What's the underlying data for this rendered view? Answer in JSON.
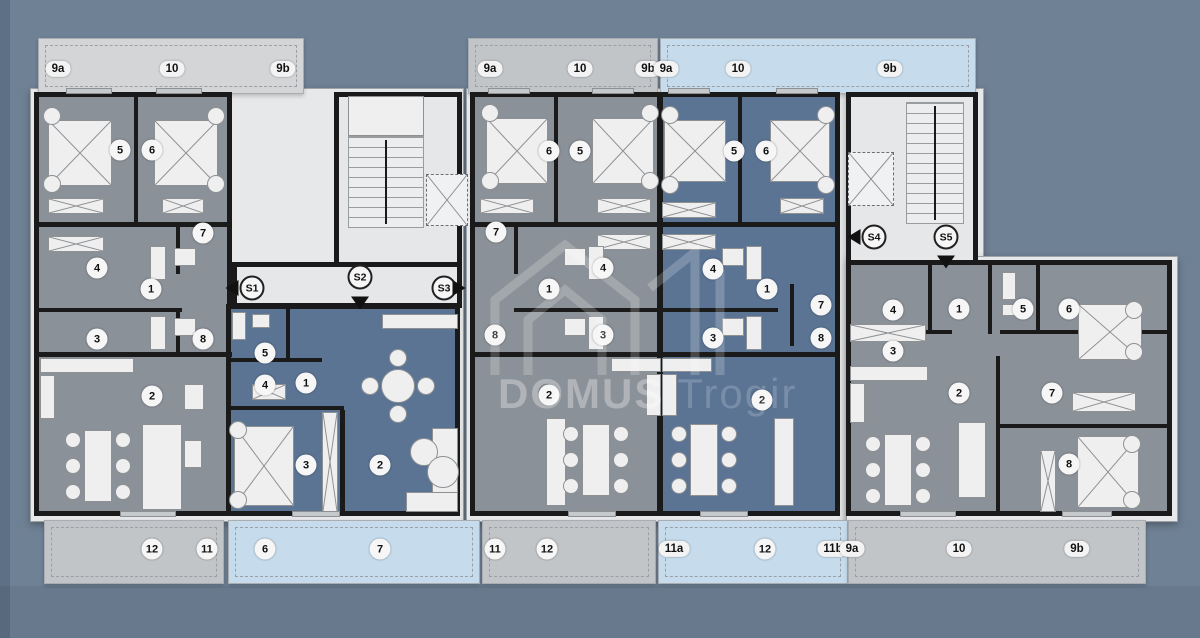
{
  "colors": {
    "background": "#6f8195",
    "apartment_gray": "#8b9198",
    "apartment_blue": "#5b7494",
    "balcony_light_gray": "#d3d5d7",
    "balcony_gray": "#c2c5c8",
    "balcony_blue": "#c6dcec",
    "corridor_light": "#e6e7e8",
    "wall": "#1a1a1a"
  },
  "watermark": {
    "brand_bold": "DOMUS",
    "brand_light": "Trogir"
  },
  "top_balconies": [
    {
      "labels": [
        "9a",
        "10",
        "9b"
      ]
    },
    {
      "labels": [
        "9a",
        "10",
        "9b"
      ]
    },
    {
      "labels": [
        "9a",
        "10",
        "9b"
      ]
    }
  ],
  "bottom_balconies": [
    {
      "labels": [
        "12",
        "11"
      ]
    },
    {
      "labels": [
        "6",
        "7"
      ]
    },
    {
      "labels": [
        "11",
        "12"
      ]
    },
    {
      "labels": [
        "11a",
        "12",
        "11b"
      ]
    },
    {
      "labels": [
        "9a",
        "10",
        "9b"
      ]
    }
  ],
  "stairs": {
    "s1": "S1",
    "s2": "S2",
    "s3": "S3",
    "s4": "S4",
    "s5": "S5"
  },
  "apartments": {
    "left_gray": {
      "rooms": [
        "5",
        "6",
        "7",
        "4",
        "1",
        "3",
        "8",
        "2"
      ]
    },
    "left_blue": {
      "rooms": [
        "5",
        "4",
        "1",
        "3",
        "2"
      ]
    },
    "middle_gray": {
      "rooms": [
        "6",
        "5",
        "7",
        "4",
        "1",
        "8",
        "3",
        "2"
      ]
    },
    "middle_blue": {
      "rooms": [
        "5",
        "6",
        "4",
        "1",
        "7",
        "3",
        "8",
        "2"
      ]
    },
    "right": {
      "rooms": [
        "4",
        "1",
        "5",
        "6",
        "3",
        "2",
        "7",
        "8"
      ]
    }
  }
}
